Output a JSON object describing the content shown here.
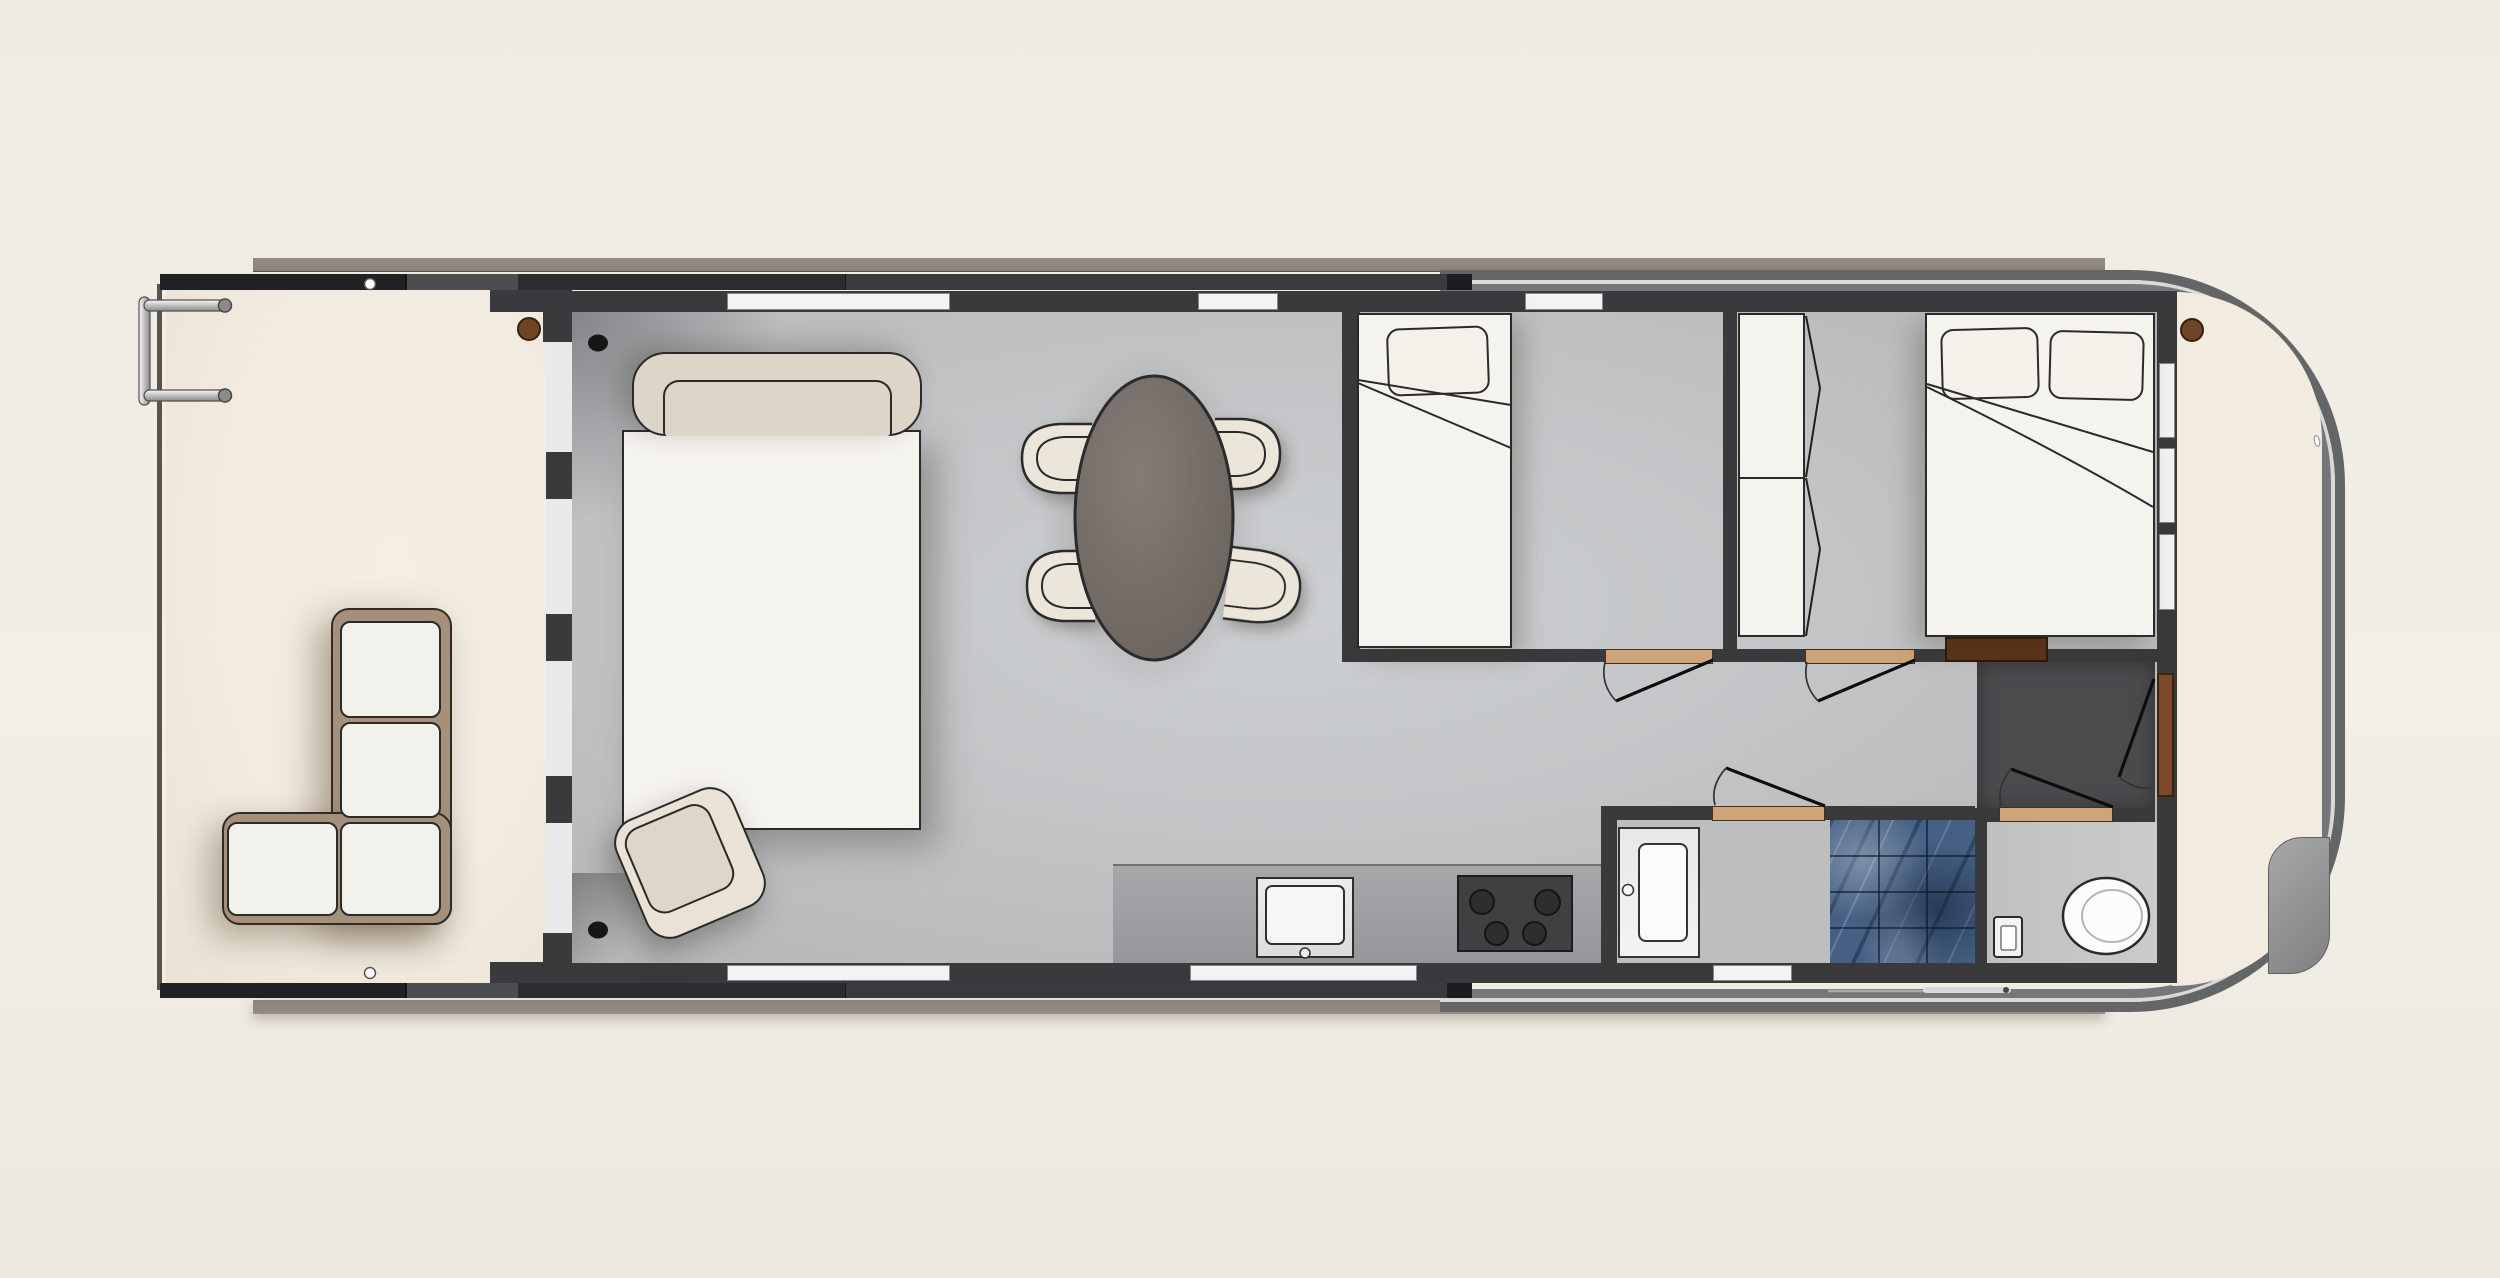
{
  "scene": {
    "kind": "architectural-floor-plan",
    "subject": "houseboat",
    "view": "top-down",
    "canvas": {
      "width": 2500,
      "height": 1278
    },
    "visible_text": []
  },
  "palette": {
    "background": "#f0ece3",
    "roof_edge": "#8a8278",
    "hull_band": "#636567",
    "hull_chrome_line": "#d9d9d7",
    "bulwark_black": "#202124",
    "interior_wall": "#3a3a3c",
    "glass_wall": "#e9e9e9",
    "window_white": "#f3f3f3",
    "deck_floor_cream": "#f2ebdf",
    "interior_floor_gray": "#c2c4c6",
    "bathroom_floor": "#bcbec0",
    "toilet_room_floor": "#c9cbcd",
    "entry_nook_dark": "#4b4b4e",
    "door_threshold_wood": "#d0a47b",
    "deck_door_brown": "#7c4a28",
    "sideboard_dark_brown": "#5e3317",
    "upholstery_cream": "#ddd5c7",
    "mattress_white": "#f5f3ee",
    "sofa_frame_tan": "#a5907b",
    "dining_table_gray_brown": "#756e68",
    "kitchen_counter": "#9e9fa1",
    "stove_dark": "#3f4042",
    "shower_tile_blue": "#456084"
  },
  "legend": {
    "rooms": [
      {
        "id": "aft-deck",
        "kind": "open deck, cream floor"
      },
      {
        "id": "salon",
        "kind": "living / dining / kitchen, gray floor"
      },
      {
        "id": "cabin-single",
        "kind": "cabin with single bed"
      },
      {
        "id": "cabin-double",
        "kind": "cabin with double bed and wardrobe"
      },
      {
        "id": "hallway",
        "kind": "corridor with four swing doors"
      },
      {
        "id": "bathroom",
        "kind": "vanity and blue marble shower"
      },
      {
        "id": "toilet-room",
        "kind": "toilet and cistern"
      },
      {
        "id": "entry-nook",
        "kind": "dark-floored entry by bow door"
      },
      {
        "id": "bow-deck",
        "kind": "rounded bow deck with railing and helm console"
      }
    ],
    "furniture": [
      "l-shaped-sofa",
      "boarding-ladder",
      "daybed-with-headboard",
      "ottoman",
      "oval-dining-table",
      "dining-chair-x4",
      "kitchen-counter",
      "kitchen-sink",
      "stove-4-burners",
      "single-bed",
      "double-bed",
      "pillows",
      "wardrobe",
      "bathroom-vanity",
      "shower-tiled",
      "toilet",
      "cistern",
      "helm-console",
      "boat-hook",
      "mooring-cleats",
      "deck-posts"
    ]
  }
}
